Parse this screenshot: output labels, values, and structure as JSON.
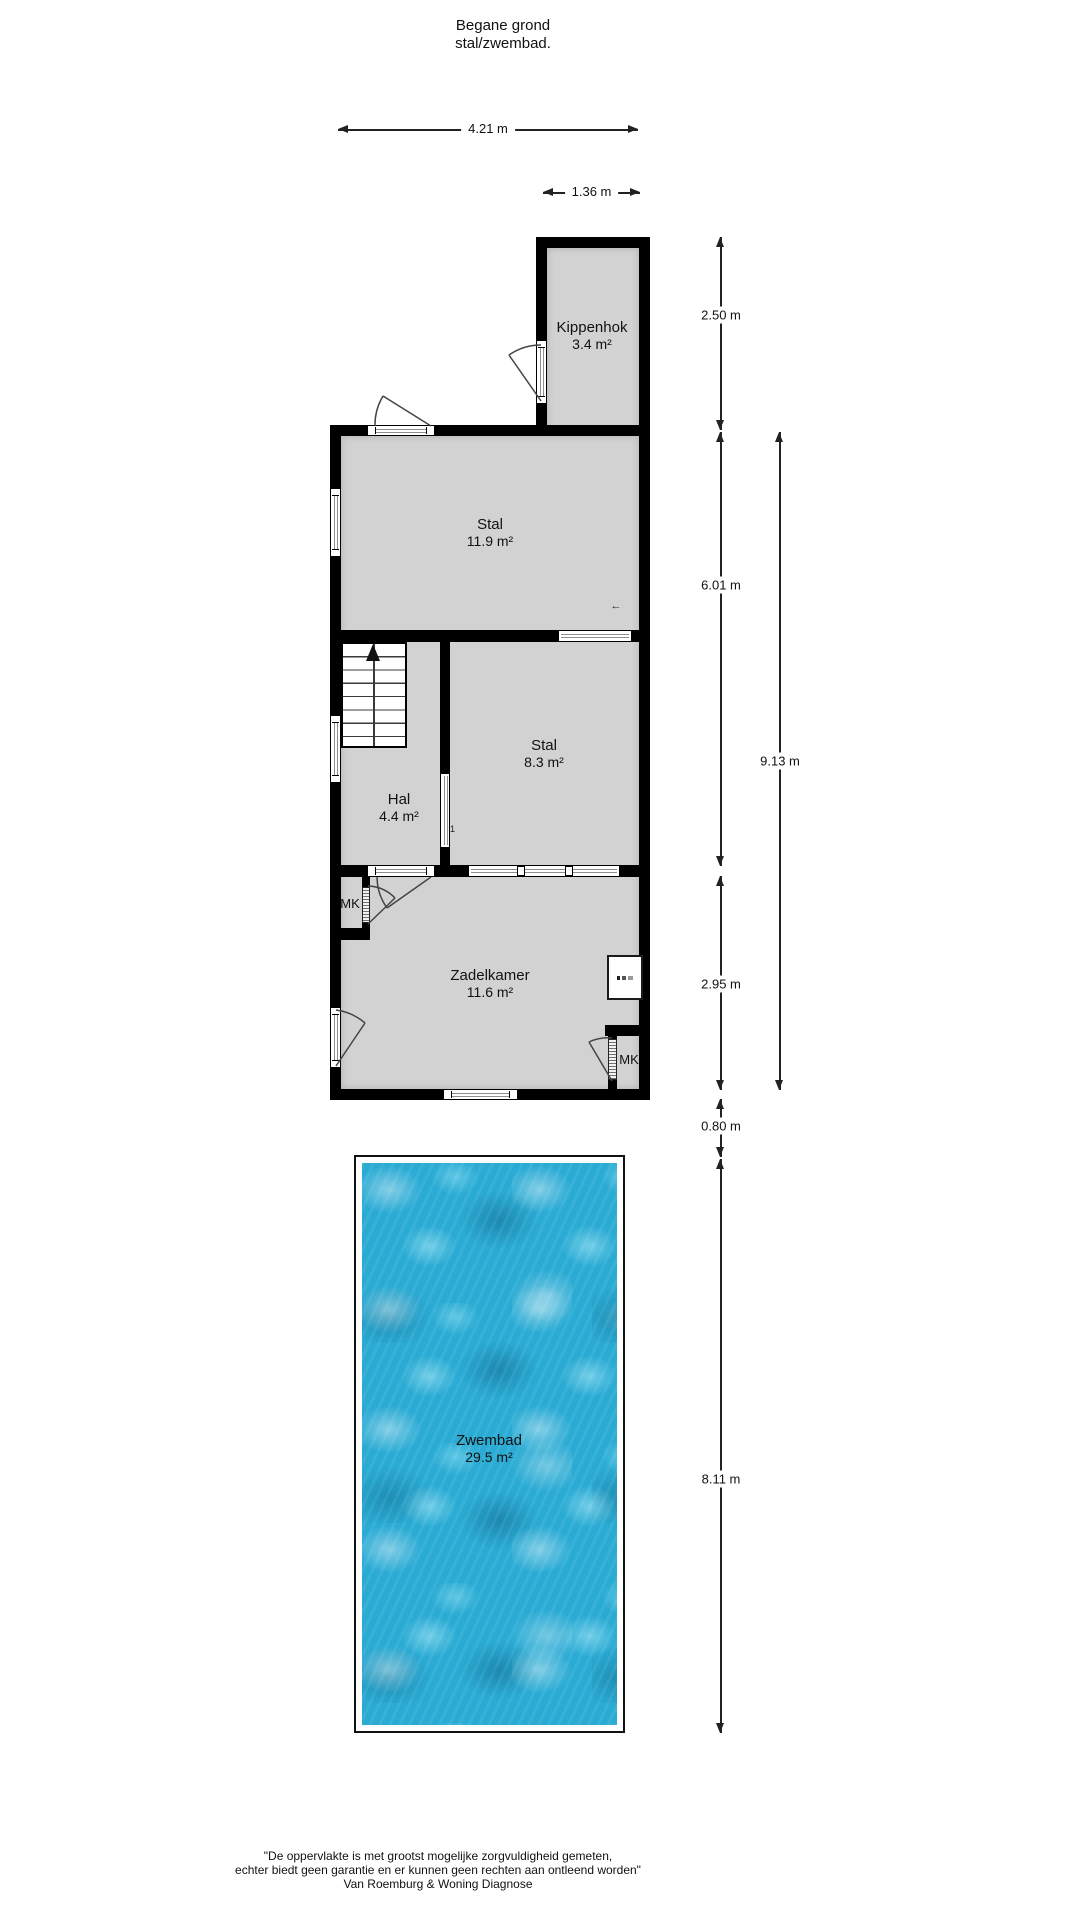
{
  "title": {
    "line1": "Begane grond",
    "line2": "stal/zwembad."
  },
  "rooms": {
    "kippenhok": {
      "name": "Kippenhok",
      "area": "3.4 m²"
    },
    "stal_large": {
      "name": "Stal",
      "area": "11.9 m²"
    },
    "stal_small": {
      "name": "Stal",
      "area": "8.3 m²"
    },
    "hal": {
      "name": "Hal",
      "area": "4.4 m²"
    },
    "zadelkamer": {
      "name": "Zadelkamer",
      "area": "11.6 m²"
    },
    "zwembad": {
      "name": "Zwembad",
      "area": "29.5 m²"
    },
    "mk_left": {
      "name": "MK"
    },
    "mk_right": {
      "name": "MK"
    }
  },
  "dimensions": {
    "building_width": "4.21 m",
    "kippenhok_width": "1.36 m",
    "kippenhok_height": "2.50 m",
    "stal_section_height": "6.01 m",
    "building_total_height": "9.13 m",
    "zadelkamer_height": "2.95 m",
    "gap": "0.80 m",
    "pool_height": "8.11 m"
  },
  "annotations": {
    "level_arrow": "←",
    "door_mark": "1"
  },
  "footer": {
    "line1": "\"De oppervlakte is met grootst mogelijke zorgvuldigheid gemeten,",
    "line2": "echter biedt geen garantie en er kunnen geen rechten aan ontleend worden\"",
    "line3": "Van Roemburg & Woning Diagnose"
  },
  "colors": {
    "wall": "#000000",
    "room_fill": "#d2d2d2",
    "water": "#2aabd4"
  }
}
